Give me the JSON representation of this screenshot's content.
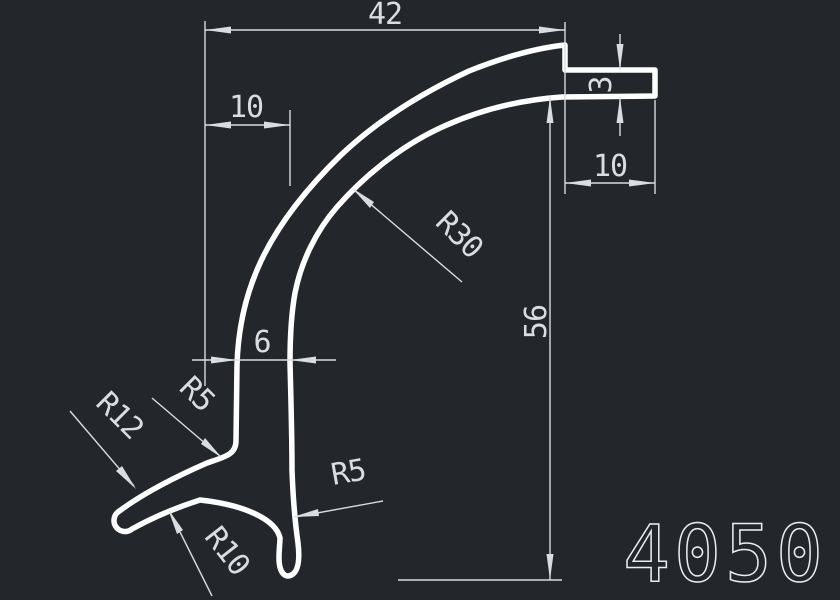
{
  "colors": {
    "background": "#23272c",
    "profile_stroke": "#ffffff",
    "dimension_stroke": "#d9dde0",
    "part_number_stroke": "#e9edf0"
  },
  "drawing": {
    "part_number": "4050",
    "dims": {
      "top_width": "42",
      "top_left_offset": "10",
      "lip_thickness": "3",
      "lip_width": "10",
      "overall_height": "56",
      "stem_width": "6"
    },
    "radii": {
      "main_curve": "R30",
      "stem_foot_fillet": "R5",
      "foot_top": "R12",
      "foot_underside": "R10",
      "bottom_fillet": "R5"
    }
  }
}
